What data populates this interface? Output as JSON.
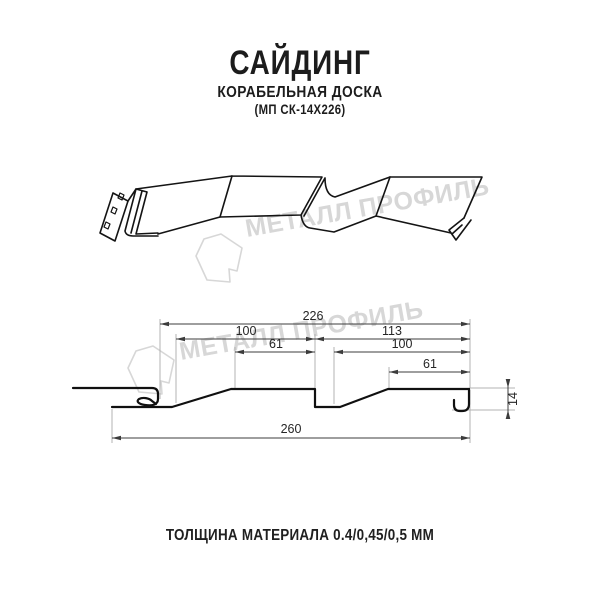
{
  "title": {
    "product": "САЙДИНГ",
    "variant": "КОРАБЕЛЬНАЯ ДОСКА",
    "model": "(МП СК-14Х226)"
  },
  "watermark": {
    "brand": "МЕТАЛЛ ПРОФИЛЬ"
  },
  "drawing": {
    "dims": {
      "total_width": "260",
      "cover_width": "226",
      "left_panel_width": "100",
      "left_panel_top": "61",
      "right_section_width": "113",
      "right_panel_width": "100",
      "right_panel_top": "61",
      "profile_height": "14"
    }
  },
  "footer": {
    "thickness": "ТОЛЩИНА МАТЕРИАЛА 0.4/0,45/0,5 ММ"
  },
  "colors": {
    "line": "#141414",
    "dimension": "#3c3c3c",
    "extension": "#b3b3b3",
    "watermark": "#d7d7d7",
    "background": "#ffffff"
  }
}
